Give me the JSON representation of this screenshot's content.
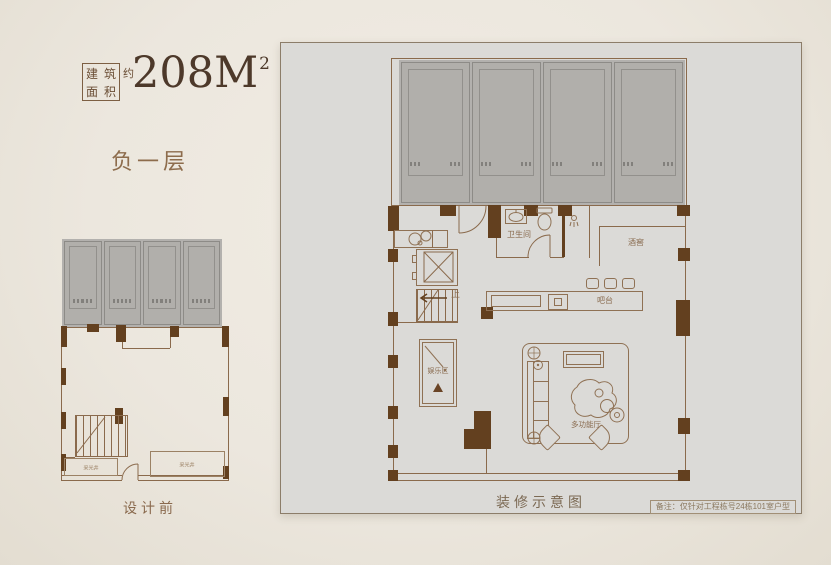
{
  "header": {
    "area_box_chars": [
      "建",
      "筑",
      "面",
      "积"
    ],
    "approx": "约",
    "area_value": "208M",
    "area_sup": "2",
    "floor_label": "负一层"
  },
  "before_plan": {
    "caption": "设计前",
    "parking_bays": 4,
    "labels": {
      "lightwell_left": "采光井",
      "lightwell_right": "采光井"
    }
  },
  "after_plan": {
    "caption": "装修示意图",
    "note": "备注：仅针对工程栋号24栋101室户型",
    "parking_bays": 4,
    "labels": {
      "bathroom": "卫生间",
      "wine_cellar": "酒窖",
      "bar": "吧台",
      "entertainment": "娱乐区",
      "multi_function": "多功能厅",
      "stairs_up": "上"
    }
  },
  "colors": {
    "background": "#ece7de",
    "panel_bg": "#dbdad7",
    "parking_gray": "#b3b1ae",
    "wall_line": "#8a6a4c",
    "wall_pier": "#63401f",
    "text_brown": "#8a6a4e",
    "title_brown": "#4d392a"
  }
}
